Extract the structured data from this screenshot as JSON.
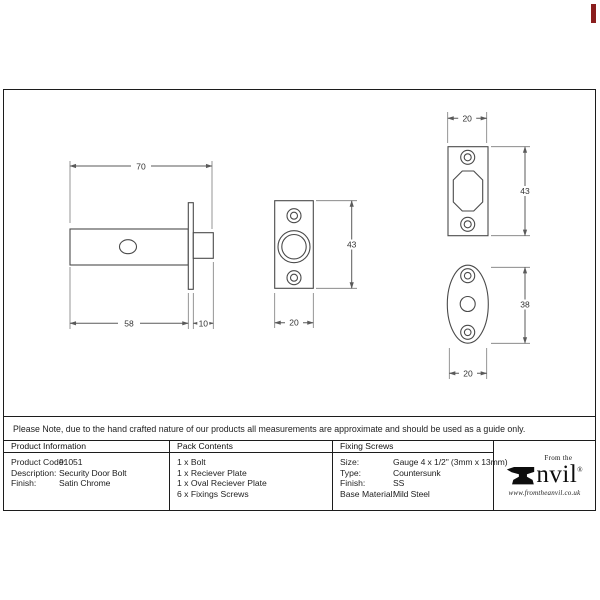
{
  "drawings": {
    "bolt": {
      "total_length": "70",
      "body_length": "58",
      "tip_length": "10"
    },
    "plate_front": {
      "height": "43",
      "width": "20"
    },
    "receiver": {
      "width": "20",
      "height": "43"
    },
    "oval": {
      "height": "38",
      "width": "20"
    }
  },
  "note": {
    "text": "Please Note, due to the hand crafted nature of our products all measurements are approximate and should be used as a guide only."
  },
  "table": {
    "product_information": {
      "header": "Product Information",
      "rows": [
        {
          "label": "Product Code:",
          "value": "91051"
        },
        {
          "label": "Description:",
          "value": "Security Door Bolt"
        },
        {
          "label": "Finish:",
          "value": "Satin Chrome"
        }
      ]
    },
    "pack_contents": {
      "header": "Pack Contents",
      "items": [
        "1 x Bolt",
        "1 x Reciever Plate",
        "1 x Oval Reciever Plate",
        "6 x Fixings Screws"
      ]
    },
    "fixing_screws": {
      "header": "Fixing Screws",
      "rows": [
        {
          "label": "Size:",
          "value": "Gauge 4 x 1/2\" (3mm x 13mm)"
        },
        {
          "label": "Type:",
          "value": "Countersunk"
        },
        {
          "label": "Finish:",
          "value": "SS"
        },
        {
          "label": "Base Material:",
          "value": "Mild Steel"
        }
      ]
    },
    "logo": {
      "tagline": "From the",
      "brand_tail": "nvil",
      "registered": "®",
      "url": "www.fromtheanvil.co.uk"
    }
  },
  "colors": {
    "corner_mark": "#8a1e1e",
    "line": "#4a4a4a",
    "border": "#1c1c1c"
  }
}
